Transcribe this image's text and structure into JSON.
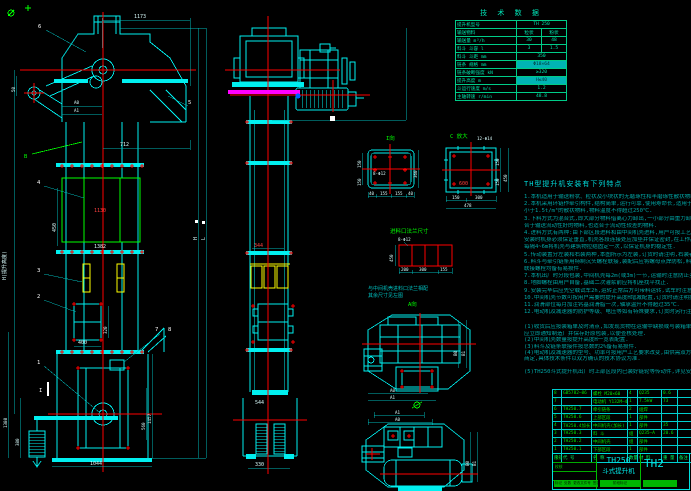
{
  "front": {
    "dims": {
      "d1173": "1173",
      "d712": "712",
      "d1130": "1130",
      "d1382": "1382",
      "d450": "450",
      "d400": "400",
      "d320": "320",
      "d1044": "1044",
      "d1380": "1380",
      "d380": "380",
      "d560": "560",
      "d1457": "1457",
      "d50": "50",
      "a0": "A0",
      "a1": "A1",
      "hTotal": "H(提升高度)",
      "lLabel": "L",
      "hLabel": "H"
    },
    "leaders": {
      "n1": "1",
      "n2": "2",
      "n3": "3",
      "n4": "4",
      "n5": "5",
      "n6": "6",
      "n7": "7",
      "n8": "8",
      "b": "B",
      "i": "I"
    }
  },
  "side": {
    "dims": {
      "d344": "344",
      "d544": "544",
      "d330": "330"
    }
  },
  "details": {
    "view_i": {
      "title": "I向",
      "holes": "8-Φ12",
      "right": "360",
      "l1": "150",
      "l2": "150",
      "b1": "40",
      "b2": "155",
      "b3": "155",
      "b4": "40"
    },
    "view_c": {
      "title": "C 放大",
      "holes": "12-Φ14",
      "inner": "600",
      "r1": "150",
      "r2": "150",
      "rr": "450",
      "b1": "150",
      "b2": "300",
      "total": "478"
    },
    "inlet": {
      "title": "进料口法兰尺寸",
      "holes": "8-Φ12",
      "h": "450",
      "b1": "200",
      "b2": "300",
      "b3": "155",
      "note1": "与中间机壳进料口法兰相配",
      "note2": "其余尺寸见左图",
      "a_view": "A向"
    },
    "plan1": {
      "a0": "A0",
      "a1": "A1",
      "b0": "B0",
      "b1": "B1"
    },
    "plan2": {
      "a0": "A0",
      "a1": "A1",
      "b0": "B0",
      "b1": "B1"
    }
  },
  "tech": {
    "title": "技 术 数 据",
    "rows": [
      {
        "label": "提升机型号",
        "v": "TH 250"
      },
      {
        "label": "输送物料",
        "v1": "粒状",
        "v2": "粉状"
      },
      {
        "label": "输送量 m³/h",
        "v1": "30",
        "v2": "48"
      },
      {
        "label": "料斗 斗容 l",
        "v1": "3",
        "v2": "1.5"
      },
      {
        "label": "料斗 斗距 mm",
        "v": "350"
      },
      {
        "label": "链条 规格 mm",
        "v": "Φ18×64"
      },
      {
        "label": "链条破断强度 kN",
        "v": "≥320"
      },
      {
        "label": "提升高度 m",
        "v": "H≤40"
      },
      {
        "label": "斗运行速度 m/s",
        "v": "1.2"
      },
      {
        "label": "主轴转速 r/min",
        "v": "48.8"
      }
    ]
  },
  "notes": {
    "title": "TH型提升机安装有下列特点",
    "lines": [
      "1.本机适用于输送粉状、粒状及小块状的无磨琢性和半磨琢性散状物料,不宜一般",
      "2.本机采用环链作牵引构件,结构简单,运行可靠,使用寿命长,适用于提升堆积密度",
      "  小于1.5t/m³的散状物料,物料温度不得超过250℃.",
      "3.下料方式为混合式,即大部分物料借离心力卸出,一小部分由重力卸料,因此既适",
      "  合于输送流动性好的物料,也适合于流动性较差的物料.",
      "4.进料方式有两种:由下部区段进料和由中间机壳进料,用户可按工艺布置任选其一;",
      "  安装时机身必须保证垂直,机壳各段连接处应加垫并保证密封,在工作高度范围内",
      "  每隔4~6m将机壳与建筑物拉结固定一次,以保证机身的稳定性.",
      "5.传动装置分左装和右装两种,本图所示为左装,订货时请注明,右装者与此相反.",
      "6.料斗与牵引链条用特制沉头螺栓联接,装配后应将螺母点焊防松,料斗及",
      "  联接螺栓均备有易损件.",
      "7.本机出厂时分段包装,中间机壳每2m(或3m)一节,运输时注意防止变形.",
      "8.地脚螺栓由用户自备,基础二次灌浆前应将机座找平找正.",
      "9.安装完毕后应先空载试车2h,运转正常后方可带料运转,试车时注意调整链条张紧度.",
      "10.中间机壳节数可按用户需要的提升高度H增减配置,订货时请注明提升高度H.",
      "11.润滑部位每月加注钙基润滑脂一次,轴承温升不得超过35℃.",
      "12.电动机及减速器的防护等级、电压等如有特殊要求,订货时另行注明."
    ],
    "lines2": [
      "(1)收货后应按装箱单及时清点,如发现货物在运输中缺损或与装箱单不符时,",
      "  应立即通知制造厂并保存好原包装,以便查核处理.",
      "(2)中间机壳数量按提升高度H一览表配置.",
      "(3)料斗及链条联接件按总数的2%备有易损件.",
      "(4)电动机及减速器的型号、功率可按用户工艺要求改变,由供需双方在订货时",
      "  商定,具体技术条件以双方确认的技术协议为准."
    ],
    "line3": "(5)TH250斗式提升机出厂时上部区段内已装好链轮等传动件,详见安装图."
  },
  "bom": {
    "headers": [
      "序号",
      "代 号",
      "名 称",
      "数量",
      "材 料",
      "重 量",
      "备注"
    ],
    "rows": [
      [
        "8",
        "GB5782—86",
        "螺栓 M20×60",
        "4",
        "Q235",
        "0.6",
        ""
      ],
      [
        "7",
        "",
        "电动机 Y132M—4",
        "1",
        "7.5kW",
        "73",
        ""
      ],
      [
        "6",
        "TH250.7",
        "牵引链条",
        "2",
        "组焊",
        "",
        ""
      ],
      [
        "5",
        "TH250.6",
        "上部区段",
        "1",
        "部件",
        "",
        ""
      ],
      [
        "4",
        "TH250.4加长",
        "中间机壳(加长)",
        "1",
        "部件",
        "35",
        ""
      ],
      [
        "3",
        "TH250.3",
        "料 斗",
        "组",
        "Q235—A",
        "20.6",
        ""
      ],
      [
        "2",
        "TH250.2",
        "中间机壳",
        "组",
        "部件",
        "",
        ""
      ],
      [
        "1",
        "TH250.1",
        "下部区段",
        "1",
        "部件",
        "",
        ""
      ]
    ]
  },
  "title_block": {
    "model": "TH250",
    "product": "斗式提升机",
    "drawing_no": "TH2",
    "rev_row": "标记 处数 更改文件号 签名 日期",
    "stage": "阶段标记",
    "sign1": "设计",
    "sign2": "校核"
  }
}
